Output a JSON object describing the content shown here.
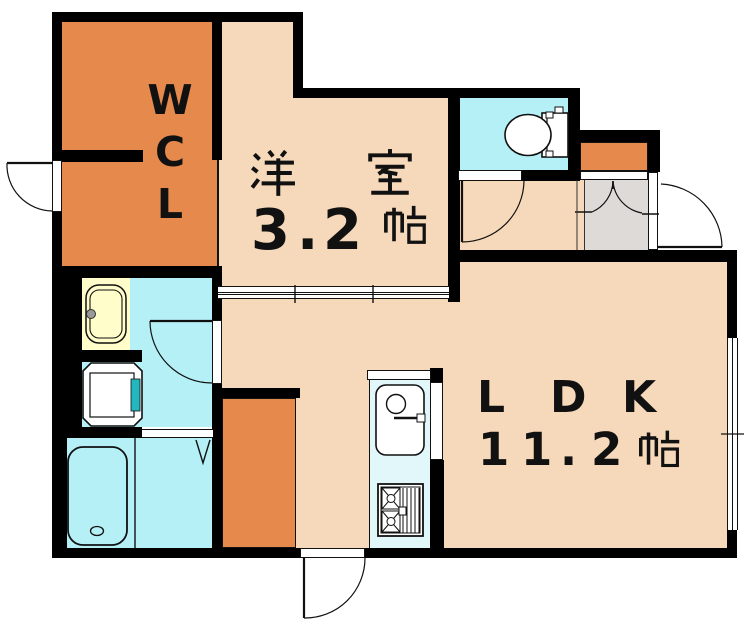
{
  "floorplan": {
    "labels": {
      "wcl": {
        "text": "WCL",
        "chars": [
          "W",
          "C",
          "L"
        ]
      },
      "western_room": {
        "kanji": "洋室",
        "size_text": "3.2帖",
        "size_chars": [
          "3",
          ".",
          "2"
        ],
        "unit_kanji": "帖"
      },
      "ldk": {
        "text": "LDK",
        "chars": [
          "L",
          "D",
          "K"
        ],
        "size_text": "11.2帖",
        "size_chars": [
          "1",
          "1",
          ".",
          "2"
        ],
        "unit_kanji": "帖"
      }
    },
    "colors": {
      "wall": "#000000",
      "room_floor_peach": "#F6D9BA",
      "closet_orange": "#E5894C",
      "wet_area_cyan": "#B4F0F6",
      "kitchen_counter_cyan": "#E2F7F9",
      "genkan_gray": "#DEDAD7",
      "washbasin_yellow": "#FFFDC9",
      "washer_pan_teal": "#25B7BE"
    }
  }
}
